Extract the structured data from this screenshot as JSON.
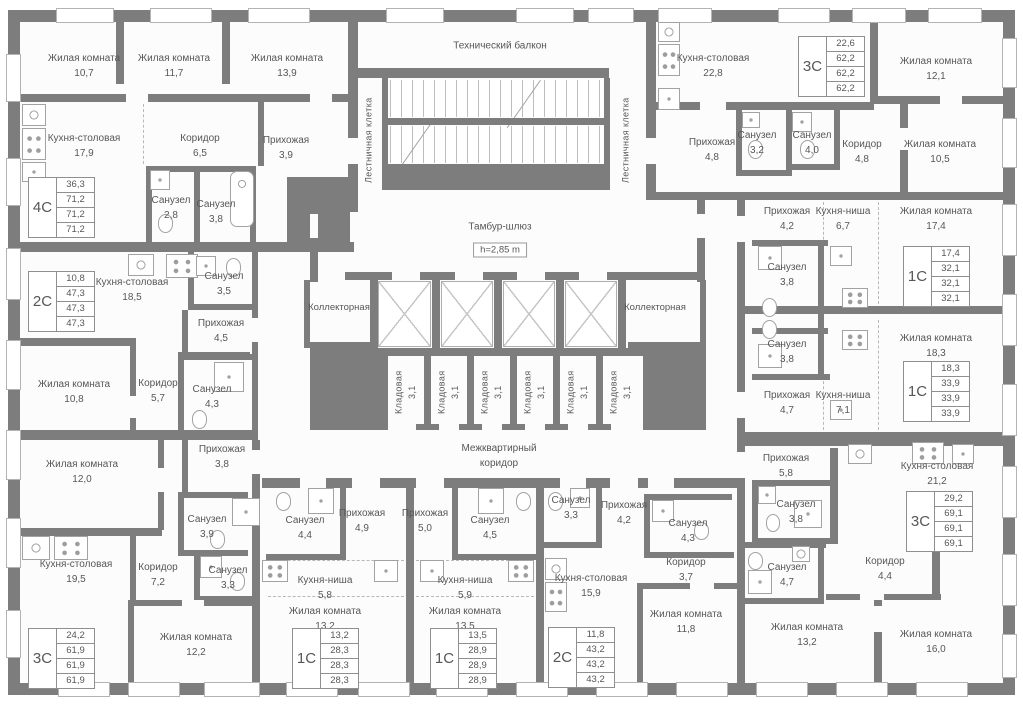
{
  "colors": {
    "wall": "#7d7d7d",
    "interior": "#fcfcfc",
    "text": "#575757",
    "outside": "#ffffff"
  },
  "common": {
    "tech_balcony": "Технический балкон",
    "stairwell": "Лестничная клетка",
    "tambur": "Тамбур-шлюз",
    "height_badge": "h=2,85 m",
    "collector": "Коллекторная",
    "storage": {
      "name": "Кладовая",
      "area": "3,1"
    },
    "corridor_line1": "Межквартирный",
    "corridor_line2": "коридор"
  },
  "rooms": [
    {
      "name": "Жилая комната",
      "area": "10,7"
    },
    {
      "name": "Жилая комната",
      "area": "11,7"
    },
    {
      "name": "Жилая комната",
      "area": "13,9"
    },
    {
      "name": "Кухня-столовая",
      "area": "17,9"
    },
    {
      "name": "Коридор",
      "area": "6,5"
    },
    {
      "name": "Прихожая",
      "area": "3,9"
    },
    {
      "name": "Санузел",
      "area": "2,8"
    },
    {
      "name": "Санузел",
      "area": "3,8"
    },
    {
      "name": "Кухня-столовая",
      "area": "18,5"
    },
    {
      "name": "Санузел",
      "area": "3,5"
    },
    {
      "name": "Прихожая",
      "area": "4,5"
    },
    {
      "name": "Жилая комната",
      "area": "10,8"
    },
    {
      "name": "Коридор",
      "area": "5,7"
    },
    {
      "name": "Санузел",
      "area": "4,3"
    },
    {
      "name": "Прихожая",
      "area": "3,8"
    },
    {
      "name": "Жилая комната",
      "area": "12,0"
    },
    {
      "name": "Санузел",
      "area": "3,9"
    },
    {
      "name": "Кухня-столовая",
      "area": "19,5"
    },
    {
      "name": "Коридор",
      "area": "7,2"
    },
    {
      "name": "Санузел",
      "area": "3,3"
    },
    {
      "name": "Жилая комната",
      "area": "12,2"
    },
    {
      "name": "Санузел",
      "area": "4,4"
    },
    {
      "name": "Прихожая",
      "area": "4,9"
    },
    {
      "name": "Кухня-ниша",
      "area": "5,8"
    },
    {
      "name": "Жилая комната",
      "area": "13,2"
    },
    {
      "name": "Прихожая",
      "area": "5,0"
    },
    {
      "name": "Санузел",
      "area": "4,5"
    },
    {
      "name": "Кухня-ниша",
      "area": "5,9"
    },
    {
      "name": "Жилая комната",
      "area": "13,5"
    },
    {
      "name": "Санузел",
      "area": "3,3"
    },
    {
      "name": "Прихожая",
      "area": "4,2"
    },
    {
      "name": "Санузел",
      "area": "4,3"
    },
    {
      "name": "Коридор",
      "area": "3,7"
    },
    {
      "name": "Кухня-столовая",
      "area": "15,9"
    },
    {
      "name": "Жилая комната",
      "area": "11,8"
    },
    {
      "name": "Прихожая",
      "area": "5,8"
    },
    {
      "name": "Кухня-столовая",
      "area": "21,2"
    },
    {
      "name": "Санузел",
      "area": "3,8"
    },
    {
      "name": "Санузел",
      "area": "4,7"
    },
    {
      "name": "Коридор",
      "area": "4,4"
    },
    {
      "name": "Жилая комната",
      "area": "13,2"
    },
    {
      "name": "Жилая комната",
      "area": "16,0"
    },
    {
      "name": "Прихожая",
      "area": "4,2"
    },
    {
      "name": "Кухня-ниша",
      "area": "6,7"
    },
    {
      "name": "Жилая комната",
      "area": "17,4"
    },
    {
      "name": "Санузел",
      "area": "3,8"
    },
    {
      "name": "Санузел",
      "area": "3,8"
    },
    {
      "name": "Прихожая",
      "area": "4,7"
    },
    {
      "name": "Кухня-ниша",
      "area": "7,1"
    },
    {
      "name": "Жилая комната",
      "area": "18,3"
    },
    {
      "name": "Кухня-столовая",
      "area": "22,8"
    },
    {
      "name": "Жилая комната",
      "area": "12,1"
    },
    {
      "name": "Прихожая",
      "area": "4,8"
    },
    {
      "name": "Санузел",
      "area": "3,2"
    },
    {
      "name": "Санузел",
      "area": "4,0"
    },
    {
      "name": "Коридор",
      "area": "4,8"
    },
    {
      "name": "Жилая комната",
      "area": "10,5"
    }
  ],
  "apartments": [
    {
      "type": "4С",
      "areas": [
        "36,3",
        "71,2",
        "71,2",
        "71,2"
      ]
    },
    {
      "type": "2С",
      "areas": [
        "10,8",
        "47,3",
        "47,3",
        "47,3"
      ]
    },
    {
      "type": "3С",
      "areas": [
        "24,2",
        "61,9",
        "61,9",
        "61,9"
      ]
    },
    {
      "type": "1С",
      "areas": [
        "13,2",
        "28,3",
        "28,3",
        "28,3"
      ]
    },
    {
      "type": "1С",
      "areas": [
        "13,5",
        "28,9",
        "28,9",
        "28,9"
      ]
    },
    {
      "type": "2С",
      "areas": [
        "11,8",
        "43,2",
        "43,2",
        "43,2"
      ]
    },
    {
      "type": "3С",
      "areas": [
        "29,2",
        "69,1",
        "69,1",
        "69,1"
      ]
    },
    {
      "type": "1С",
      "areas": [
        "17,4",
        "32,1",
        "32,1",
        "32,1"
      ]
    },
    {
      "type": "1С",
      "areas": [
        "18,3",
        "33,9",
        "33,9",
        "33,9"
      ]
    },
    {
      "type": "3С",
      "areas": [
        "22,6",
        "62,2",
        "62,2",
        "62,2"
      ]
    }
  ]
}
